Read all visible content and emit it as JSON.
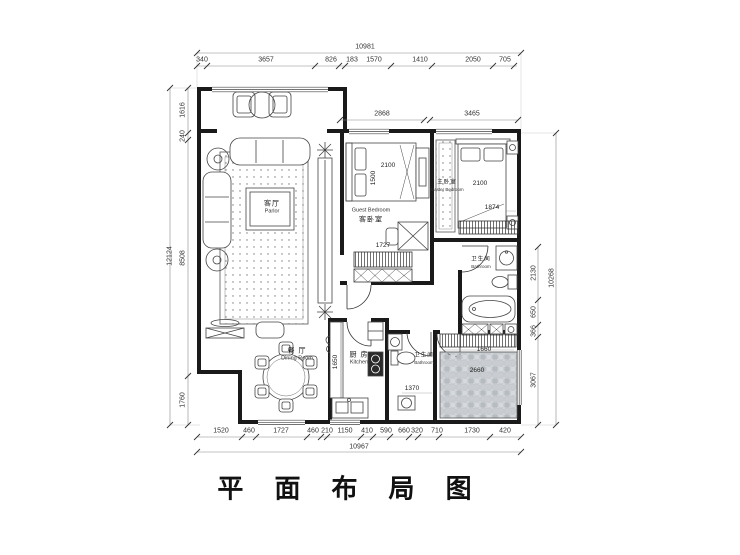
{
  "title": "平 面 布 局 图",
  "dimensions": {
    "top_total": "10981",
    "top_segments": [
      "340",
      "3657",
      "826",
      "183",
      "1570",
      "1410",
      "2050",
      "705"
    ],
    "top_inner": [
      "2868",
      "3465"
    ],
    "left_total": "12124",
    "left_segments": [
      "1616",
      "240",
      "8508",
      "1760"
    ],
    "right_total": "10268",
    "right_segments": [
      "2130",
      "650",
      "366",
      "3067"
    ],
    "bottom_total": "10967",
    "bottom_segments": [
      "1520",
      "460",
      "1727",
      "460",
      "210",
      "1150",
      "410",
      "590",
      "660",
      "320",
      "710",
      "1730",
      "420"
    ]
  },
  "feature_dims": {
    "guest_bed_width": "2100",
    "guest_bed_length": "1500",
    "guest_wardrobe": "1727",
    "master_bed_width": "2100",
    "master_bed_side": "1874",
    "kitchen_counter": "1650",
    "laundry_cabinet": "1660",
    "tiled_room": "2660",
    "bath_fixture": "1370"
  },
  "rooms": {
    "parlor": {
      "zh": "客厅",
      "en": "Parlor"
    },
    "guest_bedroom": {
      "zh": "客卧室",
      "en": "Guest Bedroom"
    },
    "master_bedroom": {
      "zh": "主卧室",
      "en": "Master Bedroom"
    },
    "dining_room": {
      "zh": "餐 厅",
      "en": "Dining Room"
    },
    "kitchen": {
      "zh": "厨 房",
      "en": "Kitchen"
    },
    "bathroom": {
      "zh": "卫生间",
      "en": "Bathroom"
    },
    "master_bathroom": {
      "zh": "卫生间",
      "en": "Bathroom"
    }
  }
}
